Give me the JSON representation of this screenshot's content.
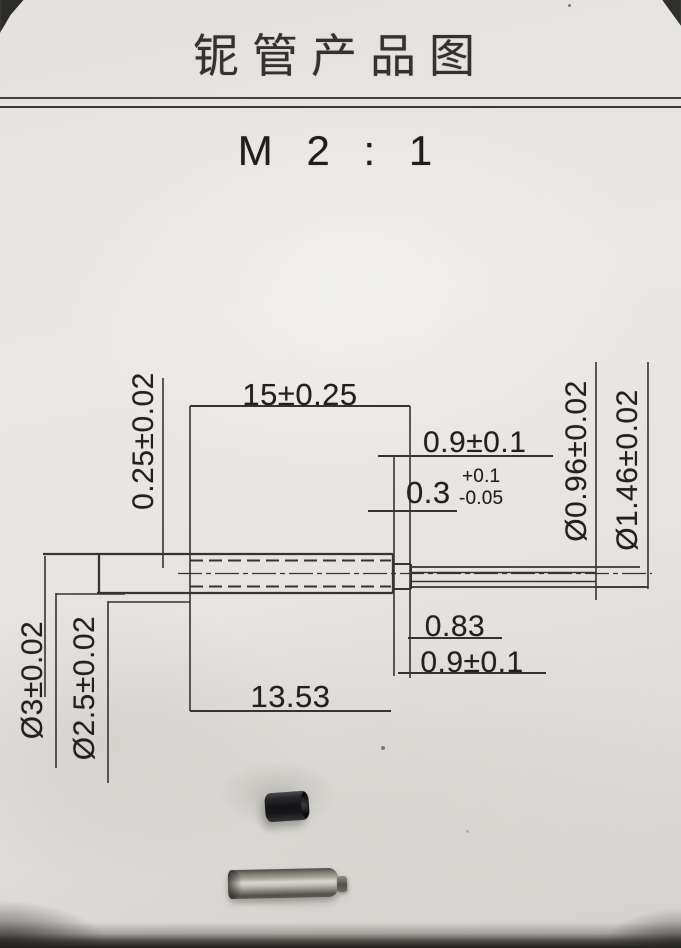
{
  "page": {
    "title": "铌管产品图",
    "scale": "M 2 : 1"
  },
  "drawing": {
    "dim_overall_length": "15±0.25",
    "dim_tip_length_top": "0.9±0.1",
    "dim_step_nominal": "0.3",
    "dim_step_tol_plus": "+0.1",
    "dim_step_tol_minus": "-0.05",
    "dim_tip_inner_dia": "Ø0.96±0.02",
    "dim_tip_outer_dia": "Ø1.46±0.02",
    "dim_wall_thickness": "0.25±0.02",
    "dim_outer_dia": "Ø3±0.02",
    "dim_bore_dia": "Ø2.5±0.02",
    "dim_step_length": "0.83",
    "dim_tip_length_bottom": "0.9±0.1",
    "dim_bore_depth": "13.53"
  },
  "colors": {
    "paper": "#e6e4e0",
    "line_ink": "#363432",
    "text_ink": "#232120"
  }
}
